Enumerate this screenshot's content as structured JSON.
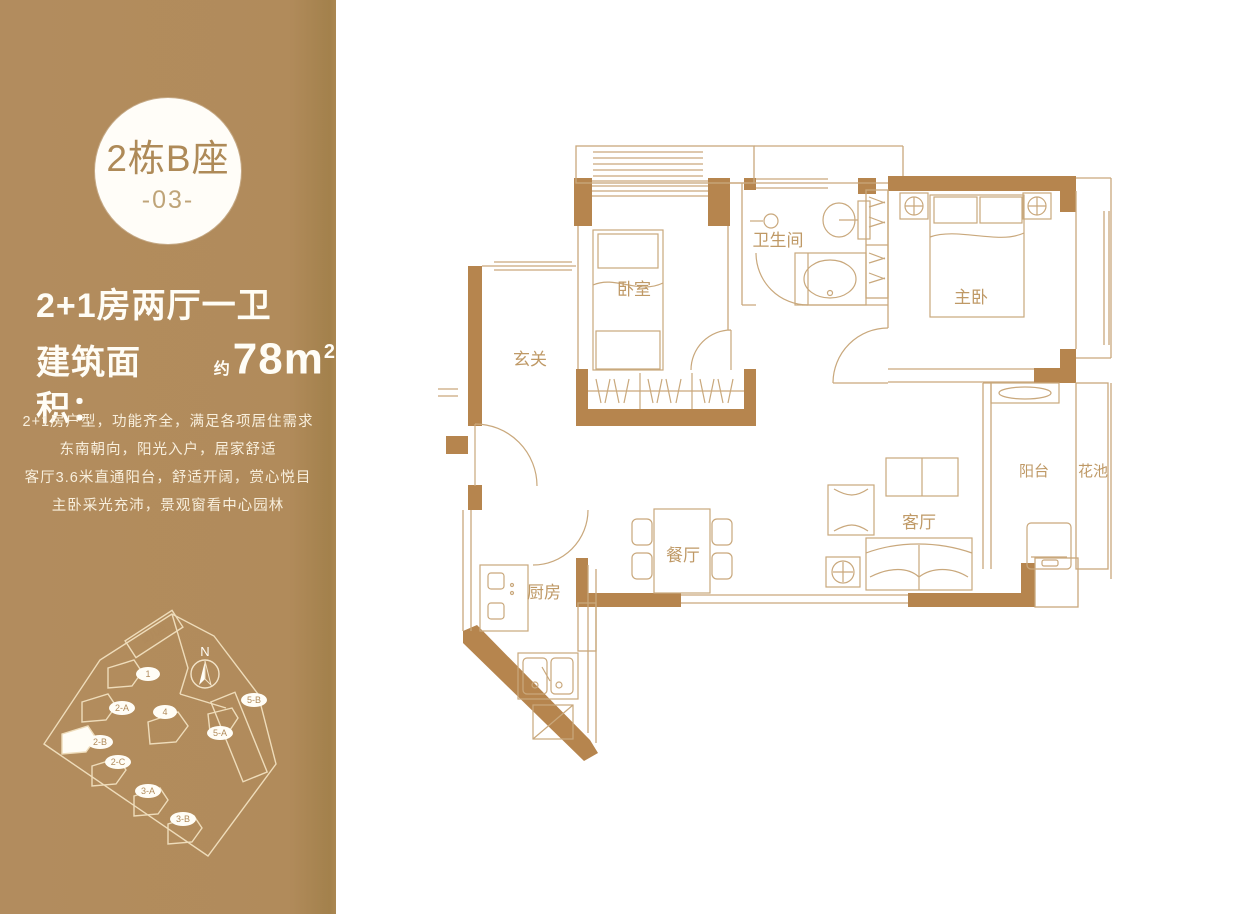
{
  "sidebar": {
    "badge": {
      "line1": "2栋B座",
      "line2": "-03-"
    },
    "headline": {
      "line1": "2+1房两厅一卫",
      "area_label": "建筑面积：",
      "area_approx": "约",
      "area_value": "78m",
      "area_sup": "2"
    },
    "description_lines": [
      "2+1房户型，功能齐全，满足各项居住需求",
      "东南朝向，阳光入户，居家舒适",
      "客厅3.6米直通阳台，舒适开阔，赏心悦目",
      "主卧采光充沛，景观窗看中心园林"
    ],
    "siteplan": {
      "north_label": "N",
      "labels": [
        "幼儿园",
        "1",
        "2-A",
        "2-B",
        "2-C",
        "3-A",
        "3-B",
        "4",
        "5-A",
        "5-B"
      ]
    }
  },
  "floorplan": {
    "rooms": [
      {
        "id": "entry",
        "label": "玄关"
      },
      {
        "id": "bedroom",
        "label": "卧室"
      },
      {
        "id": "bathroom",
        "label": "卫生间"
      },
      {
        "id": "master-bedroom",
        "label": "主卧"
      },
      {
        "id": "dining-room",
        "label": "餐厅"
      },
      {
        "id": "living-room",
        "label": "客厅"
      },
      {
        "id": "kitchen",
        "label": "厨房"
      },
      {
        "id": "balcony",
        "label": "阳台"
      },
      {
        "id": "flower-bed",
        "label": "花池"
      }
    ]
  },
  "colors": {
    "sidebar_tan": "#b18b5b",
    "wall_brown": "#b6854e",
    "plan_line": "#c9a87c",
    "room_label": "#bf9966",
    "badge_text": "#ae8a58",
    "sidebar_text": "#fffdf6"
  }
}
